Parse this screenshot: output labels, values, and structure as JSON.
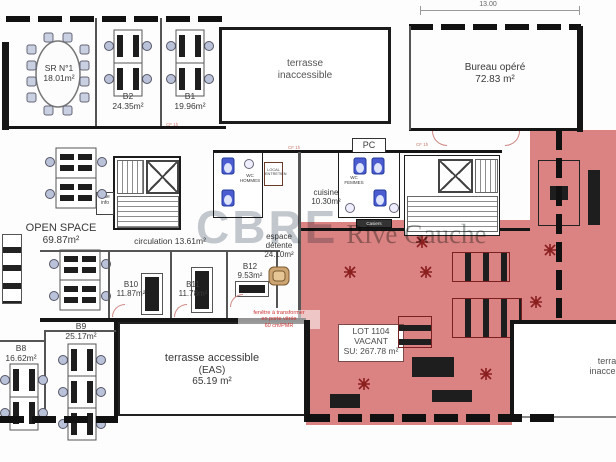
{
  "watermark": {
    "brand": "CBRE",
    "suffix": "Rive Gauche"
  },
  "dimensions": {
    "top_width": "13.00"
  },
  "rooms": {
    "sr1": {
      "name": "SR N°1",
      "area": "18.01m²"
    },
    "b2": {
      "name": "B2",
      "area": "24.35m²"
    },
    "b1": {
      "name": "B1",
      "area": "19.96m²"
    },
    "terrace_top": {
      "line1": "terrasse",
      "line2": "inaccessible"
    },
    "bureau_opere": {
      "name": "Bureau opéré",
      "area": "72.83 m²"
    },
    "pc": {
      "name": "PC"
    },
    "open_space": {
      "name": "OPEN SPACE",
      "area": "69.87m²"
    },
    "circulation": {
      "label": "circulation 13.61m²"
    },
    "cuisine": {
      "name": "cuisine",
      "area": "10.30m²"
    },
    "wc_hommes": {
      "line1": "WC",
      "line2": "HOMMES"
    },
    "wc_femmes": {
      "line1": "WC",
      "line2": "FEMMES"
    },
    "local_entretien": {
      "line1": "LOCAL",
      "line2": "ENTRETIEN"
    },
    "baie_info": {
      "line1": "baie",
      "line2": "info"
    },
    "casiers": {
      "name": "Casiers"
    },
    "espace_detente": {
      "name": "espace",
      "name2": "détente",
      "area": "24.10m²"
    },
    "b10": {
      "name": "B10",
      "area": "11.87m²"
    },
    "b11": {
      "name": "B11",
      "area": "11.78m²"
    },
    "b12": {
      "name": "B12",
      "area": "9.53m²"
    },
    "b9": {
      "name": "B9",
      "area": "25.17m²"
    },
    "b8": {
      "name": "B8",
      "area": "16.62m²"
    },
    "terrace_accessible": {
      "name": "terrasse accessible",
      "sub": "(EAS)",
      "area": "65.19 m²"
    },
    "lot": {
      "name": "LOT 1104",
      "status": "VACANT",
      "area": "SU: 267.78 m²"
    },
    "terrace_bottom_right": {
      "line1": "terrasse",
      "line2": "inaccessible"
    }
  },
  "annotations": {
    "window_note": {
      "line1": "fenêtre à transformer",
      "line2": "en porte vitrée",
      "line3": "60 cm/PMR"
    },
    "door_rating": "CF 1h"
  },
  "colors": {
    "vacant_highlight": "#db8282",
    "annotation_red": "#cc3333",
    "fixture_blue": "#4a5cd0",
    "wall": "#151515"
  }
}
